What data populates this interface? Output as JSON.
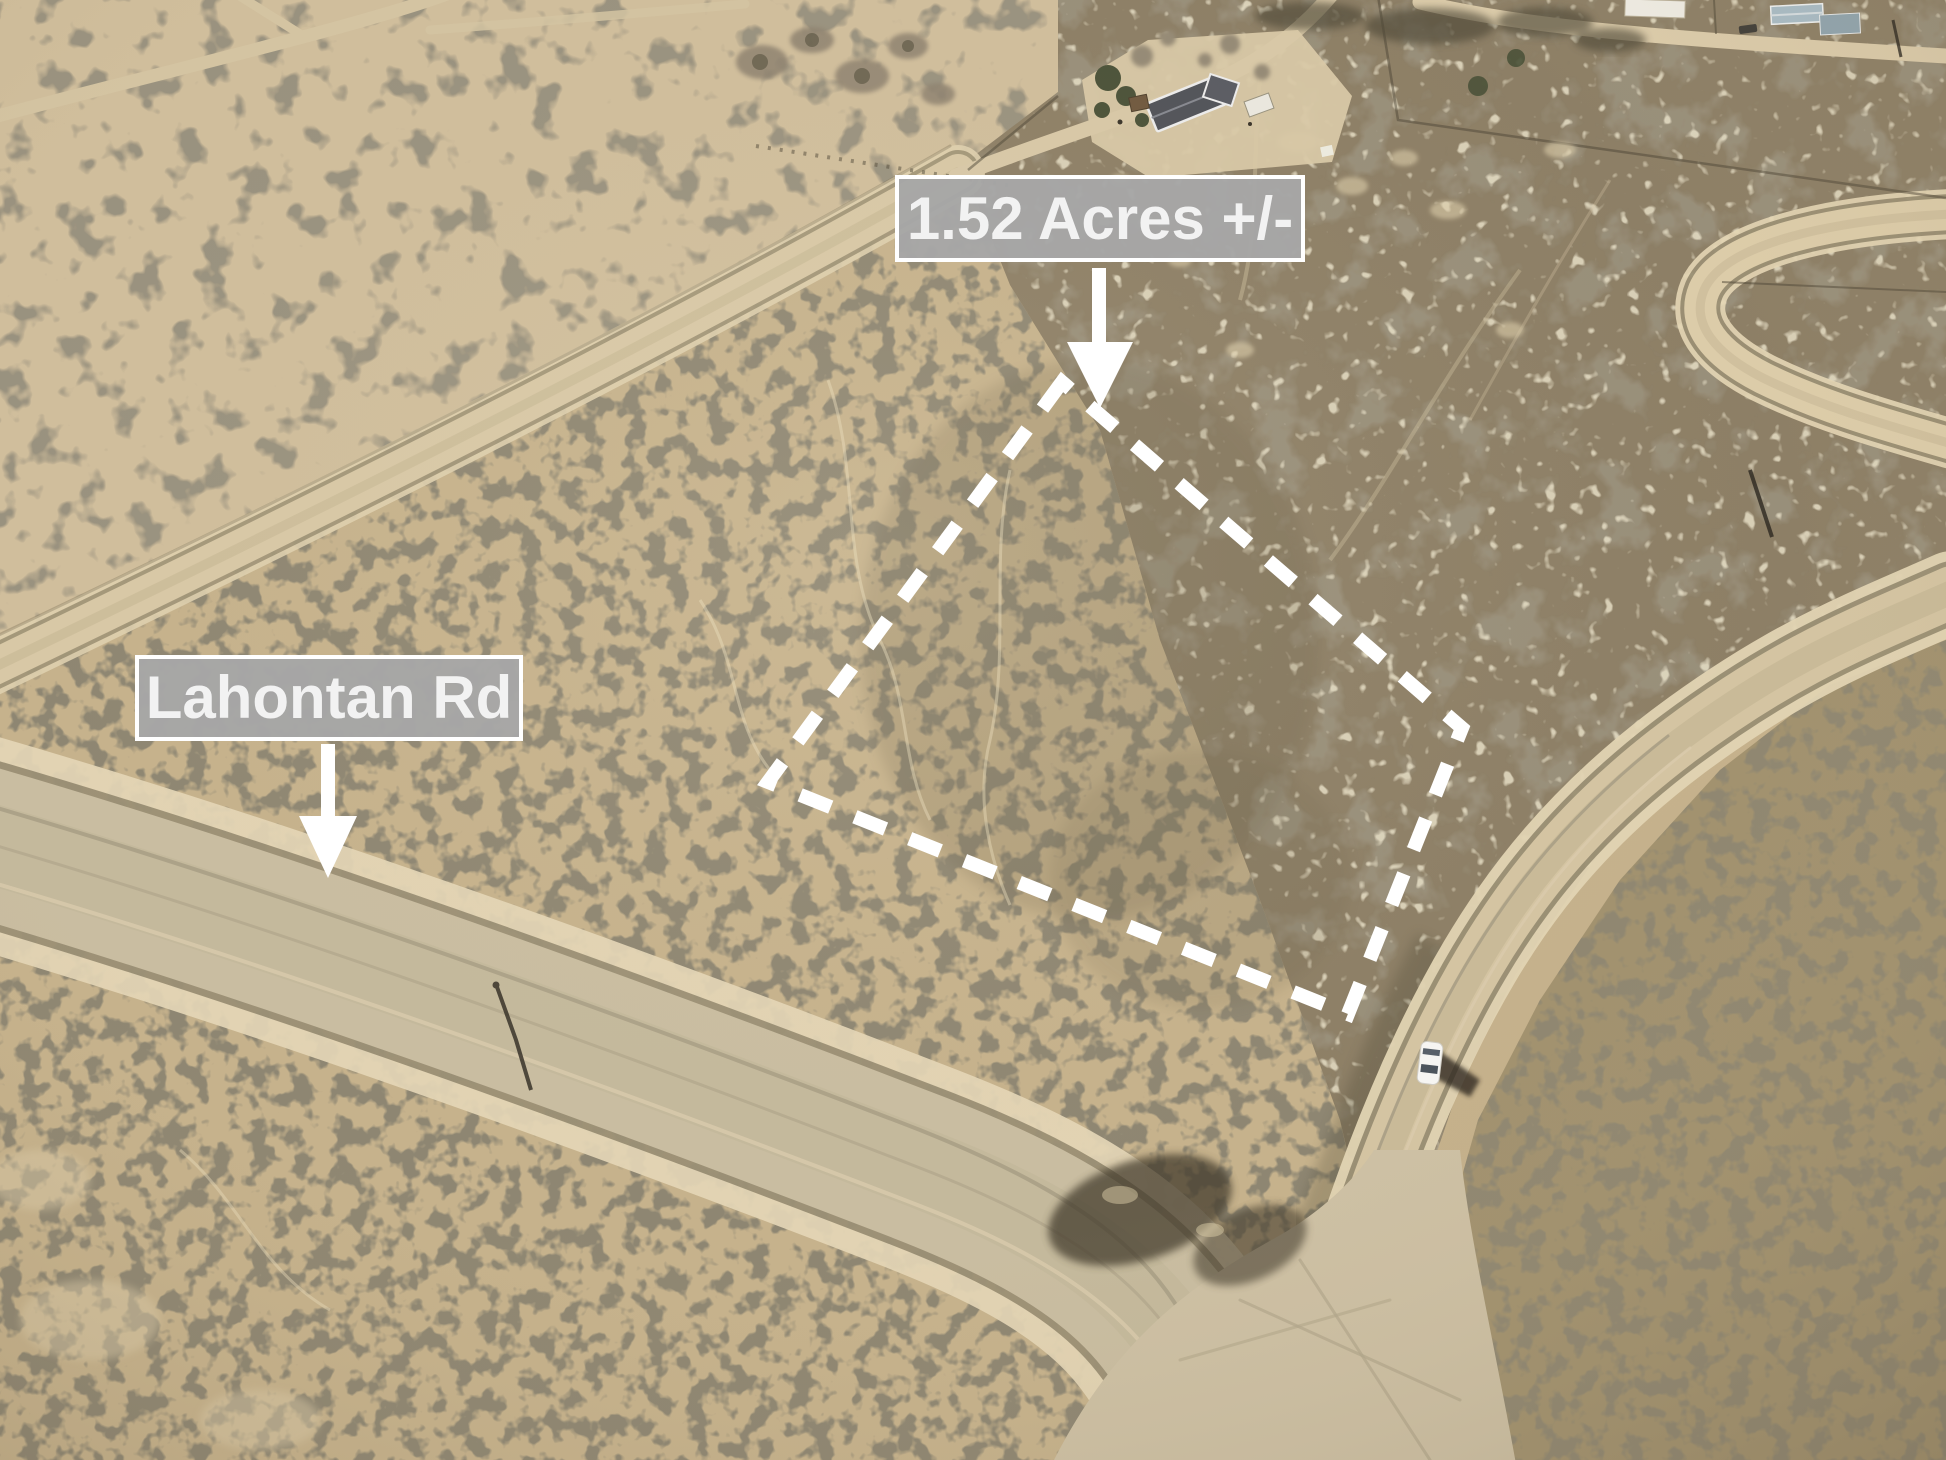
{
  "page": {
    "type": "annotated aerial drone photo of vacant land parcel",
    "width_px": 1946,
    "height_px": 1460
  },
  "labels": {
    "parcel_size": {
      "text": "1.52 Acres +/-",
      "bg_color": "#a6a6a6",
      "text_color": "#f2f2f2",
      "border_color": "#ffffff"
    },
    "road_name": {
      "text": "Lahontan Rd",
      "bg_color": "#a6a6a6",
      "text_color": "#f2f2f2",
      "border_color": "#ffffff"
    }
  },
  "boundary": {
    "style": "dashed",
    "color": "#ffffff",
    "points": "1062,382 768,782 1348,1014 1462,728"
  },
  "arrows": {
    "color": "#ffffff",
    "parcel": {
      "points_to": "parcel interior",
      "points": "1092,268 1106,268 1106,342 1133,342 1100,408 1067,342 1092,342"
    },
    "road": {
      "points_to": "Lahontan Rd roadway",
      "points": "321,744 335,744 335,816 357,816 328,878 299,816 321,816"
    }
  },
  "scene": {
    "terrain": "high-desert sagebrush flat with graded dirt roads",
    "vehicle": {
      "type": "car",
      "color": "#ffffff"
    },
    "buildings": [
      "dark-roof ranch house with trees (top center)",
      "white shed",
      "white house (top right)",
      "two blue-gray houses (top right)"
    ],
    "palette": {
      "sand": "#cbb893",
      "scrub_dark": "#4a4433",
      "road_surface": "#d6c6a4",
      "road_shoulder": "#e4d6b6",
      "pasture": "#8d7f66"
    }
  }
}
